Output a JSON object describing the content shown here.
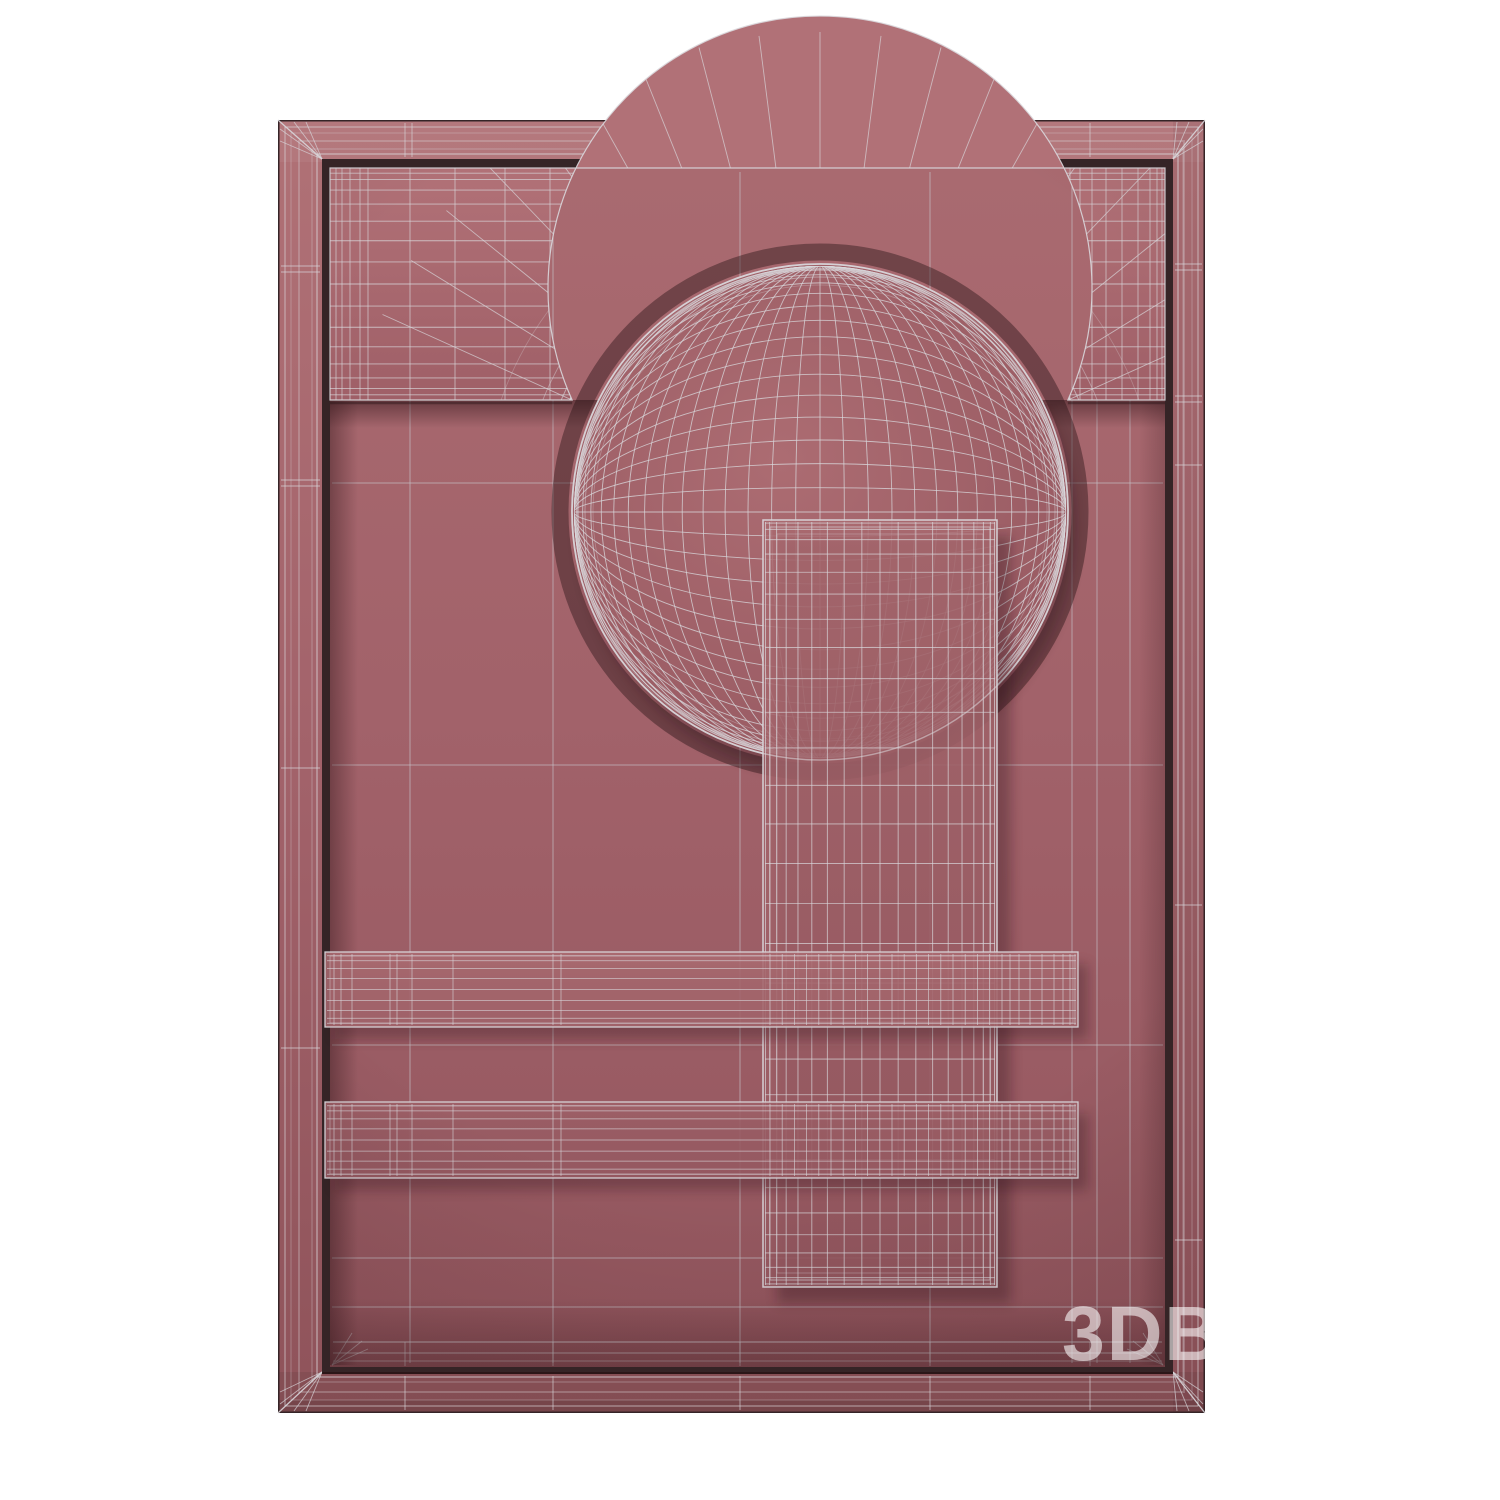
{
  "watermark": {
    "text": "3DB"
  },
  "colors": {
    "canvas_bg": "#ffffff",
    "surface": "#a2626a",
    "surface_light": "#b07176",
    "surface_dark": "#8f535a",
    "wire": "#d9d7db",
    "wire_dim": "#c6c3c9",
    "edge_dark": "#352427",
    "gap_dark": "#241114",
    "shadow_tint": "#2b1014",
    "watermark_color": "#ffffff"
  }
}
